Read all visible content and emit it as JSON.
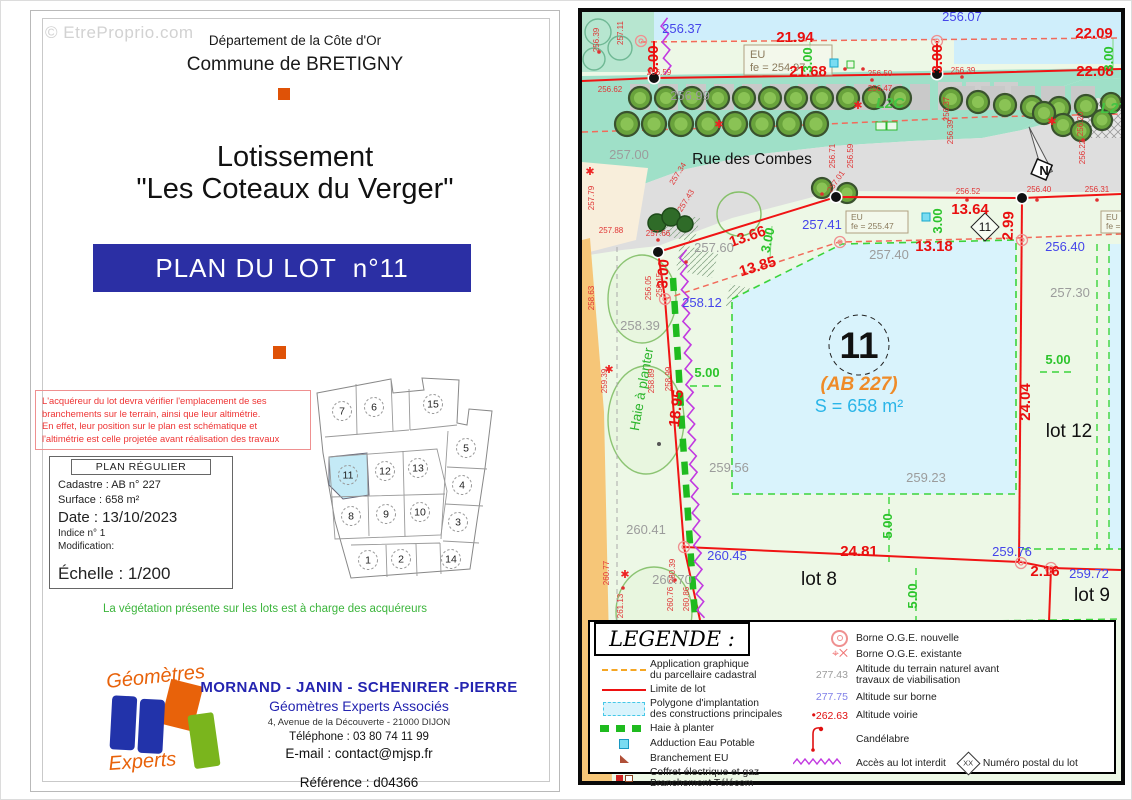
{
  "colors": {
    "banner_blue": "#2b2fa4",
    "footer_blue": "#2424b0",
    "warning_red": "#ee3434",
    "vegetation_green": "#3cb53c",
    "dim_red": "#e90f0f",
    "alt_blue": "#4545ea",
    "alt_gray": "#9c9c9c",
    "dim_green": "#2cc42c",
    "cadastre_orange": "#ef8b28",
    "area_cyan": "#2ab5e8",
    "haie_green": "#1fbb1f",
    "interdit_purple": "#c23ae0",
    "road_gray": "#dedede",
    "verge_teal": "#9fe0c8",
    "lot11_blue": "#d9f3fc",
    "left_strip_orange": "#f6c678",
    "logo_orange": "#e8620a",
    "logo_blue": "#2233aa",
    "logo_green": "#7ab51d"
  },
  "watermark": "© EtreProprio.com",
  "left_page": {
    "header1": "Département de la Côte d'Or",
    "header2": "Commune de BRETIGNY",
    "title1": "Lotissement",
    "title2": "\"Les Coteaux du Verger\"",
    "banner": "PLAN DU LOT  n°11",
    "warning": [
      "L'acquéreur du lot devra vérifier l'emplacement de ses",
      "branchements sur le terrain, ainsi que leur altimétrie.",
      "En effet, leur position sur le plan est schématique et",
      "l'altimétrie est celle projetée avant réalisation des travaux"
    ],
    "plan_box": {
      "title": "PLAN RÉGULIER",
      "cadastre": "Cadastre : AB n° 227",
      "surface": "Surface :  658 m²",
      "date": "Date : 13/10/2023",
      "indice": "Indice n° 1",
      "modification": "Modification:",
      "echelle": "Échelle :  1/200"
    },
    "overview": {
      "highlighted": "11",
      "lots": [
        {
          "n": "7",
          "x": 43,
          "y": 38
        },
        {
          "n": "6",
          "x": 75,
          "y": 34
        },
        {
          "n": "15",
          "x": 134,
          "y": 31
        },
        {
          "n": "5",
          "x": 167,
          "y": 75
        },
        {
          "n": "4",
          "x": 163,
          "y": 112
        },
        {
          "n": "3",
          "x": 159,
          "y": 149
        },
        {
          "n": "14",
          "x": 152,
          "y": 186
        },
        {
          "n": "1",
          "x": 69,
          "y": 187
        },
        {
          "n": "2",
          "x": 102,
          "y": 186
        },
        {
          "n": "8",
          "x": 52,
          "y": 143
        },
        {
          "n": "9",
          "x": 87,
          "y": 141
        },
        {
          "n": "10",
          "x": 121,
          "y": 139
        },
        {
          "n": "11",
          "x": 49,
          "y": 102
        },
        {
          "n": "12",
          "x": 86,
          "y": 98
        },
        {
          "n": "13",
          "x": 119,
          "y": 95
        }
      ]
    },
    "vegetation_note": "La végétation présente sur les lots est à charge des acquéreurs",
    "footer": {
      "firm": "MORNAND - JANIN - SCHENIRER -PIERRE",
      "firm2": "Géomètres Experts Associés",
      "address": "4, Avenue de la Découverte - 21000 DIJON",
      "phone": "Téléphone  : 03 80 74 11 99",
      "email": "E-mail : contact@mjsp.fr",
      "reference": "Référence : d04366"
    },
    "logo": {
      "top": "Géomètres",
      "bottom": "Experts"
    }
  },
  "map": {
    "street": "Rue des Combes",
    "north": "N",
    "lot": {
      "number": "11",
      "cadastre": "(AB 227)",
      "area": "S = 658 m²"
    },
    "diamond": "11",
    "eu_boxes": [
      {
        "l1": "EU",
        "l2": "fe = 254.97"
      },
      {
        "l1": "EU",
        "l2": "fe = 255.47"
      },
      {
        "l1": "EU",
        "l2": "fe = 254"
      }
    ],
    "labels": [
      [
        "21.94",
        213,
        30,
        "r",
        0
      ],
      [
        "22.09",
        512,
        26,
        "r",
        0
      ],
      [
        "21.68",
        226,
        64,
        "r",
        0
      ],
      [
        "22.08",
        513,
        64,
        "r",
        0
      ],
      [
        "3.00",
        76,
        48,
        "r",
        -90
      ],
      [
        "3.00",
        360,
        47,
        "r",
        -90
      ],
      [
        "3.00",
        230,
        48,
        "g",
        -90
      ],
      [
        "3.00",
        531,
        47,
        "g",
        -90
      ],
      [
        "256.37",
        100,
        21,
        "b",
        0
      ],
      [
        "256.07",
        380,
        9,
        "b",
        0
      ],
      [
        "13.66",
        167,
        229,
        "r",
        -19
      ],
      [
        "13.85",
        177,
        259,
        "r",
        -17
      ],
      [
        "3.00",
        190,
        229,
        "g",
        -78
      ],
      [
        "3.00",
        86,
        262,
        "r",
        -87
      ],
      [
        "257.41",
        240,
        217,
        "b",
        0
      ],
      [
        "257.60",
        132,
        240,
        "k",
        0
      ],
      [
        "258.12",
        120,
        295,
        "b",
        0
      ],
      [
        "258.39",
        58,
        318,
        "k",
        0
      ],
      [
        "13.64",
        388,
        202,
        "r",
        0
      ],
      [
        "13.18",
        352,
        239,
        "r",
        0
      ],
      [
        "2.99",
        431,
        214,
        "r",
        -88
      ],
      [
        "3.00",
        360,
        209,
        "g",
        -90
      ],
      [
        "257.40",
        307,
        247,
        "k",
        0
      ],
      [
        "256.40",
        483,
        239,
        "b",
        0
      ],
      [
        "257.30",
        488,
        285,
        "k",
        0
      ],
      [
        "257.00",
        47,
        147,
        "k",
        0
      ],
      [
        "256.99",
        108,
        88,
        "k",
        0
      ],
      [
        "259.56",
        147,
        460,
        "k",
        0
      ],
      [
        "259.23",
        344,
        470,
        "k",
        0
      ],
      [
        "260.41",
        64,
        522,
        "k",
        0
      ],
      [
        "260.45",
        145,
        548,
        "b",
        0
      ],
      [
        "260.70",
        90,
        572,
        "k",
        0
      ],
      [
        "24.04",
        448,
        390,
        "r",
        -90
      ],
      [
        "5.00",
        476,
        352,
        "g",
        0
      ],
      [
        "5.00",
        125,
        365,
        "g",
        0
      ],
      [
        "5.00",
        310,
        514,
        "g",
        -90
      ],
      [
        "5.00",
        335,
        584,
        "g",
        -90
      ],
      [
        "24.81",
        277,
        544,
        "r",
        0
      ],
      [
        "259.76",
        430,
        544,
        "b",
        0
      ],
      [
        "2.16",
        463,
        564,
        "r",
        0
      ],
      [
        "259.72",
        507,
        566,
        "b",
        0
      ],
      [
        "18.95",
        99,
        397,
        "r",
        -83
      ],
      [
        "lot 12",
        487,
        425,
        "L",
        0
      ],
      [
        "lot 8",
        237,
        573,
        "L",
        0
      ],
      [
        "lot 9",
        510,
        589,
        "L",
        0
      ],
      [
        "L2C",
        308,
        96,
        "G",
        0
      ],
      [
        "L2T",
        532,
        101,
        "G",
        0
      ],
      [
        "Haie à planter",
        64,
        378,
        "H",
        -80
      ],
      [
        "256.39",
        17,
        28,
        "s",
        -90
      ],
      [
        "257.11",
        41,
        21,
        "s",
        -90
      ],
      [
        "256.62",
        28,
        80,
        "s",
        0
      ],
      [
        "256.59",
        77,
        63,
        "s",
        0
      ],
      [
        "257.34",
        98,
        163,
        "s",
        -58
      ],
      [
        "257.43",
        106,
        190,
        "s",
        -58
      ],
      [
        "257.79",
        12,
        186,
        "s",
        -90
      ],
      [
        "257.88",
        29,
        221,
        "s",
        0
      ],
      [
        "257.66",
        76,
        224,
        "s",
        0
      ],
      [
        "258.63",
        12,
        286,
        "s",
        -90
      ],
      [
        "256.05",
        69,
        276,
        "s",
        -90
      ],
      [
        "256.15",
        80,
        273,
        "s",
        -90
      ],
      [
        "258.89",
        72,
        369,
        "s",
        -90
      ],
      [
        "258.99",
        89,
        367,
        "s",
        -90
      ],
      [
        "259.39",
        25,
        369,
        "s",
        -90
      ],
      [
        "260.77",
        27,
        561,
        "s",
        -90
      ],
      [
        "260.39",
        93,
        559,
        "s",
        -90
      ],
      [
        "261.13",
        41,
        594,
        "s",
        -90
      ],
      [
        "260.76",
        91,
        587,
        "s",
        -90
      ],
      [
        "260.86",
        107,
        587,
        "s",
        -90
      ],
      [
        "256.50",
        298,
        64,
        "s",
        0
      ],
      [
        "256.47",
        298,
        79,
        "s",
        0
      ],
      [
        "256.37",
        367,
        97,
        "s",
        -90
      ],
      [
        "256.39",
        371,
        120,
        "s",
        -90
      ],
      [
        "256.52",
        386,
        182,
        "s",
        0
      ],
      [
        "256.40",
        457,
        180,
        "s",
        0
      ],
      [
        "256.31",
        515,
        180,
        "s",
        0
      ],
      [
        "256.71",
        253,
        144,
        "s",
        -90
      ],
      [
        "256.59",
        271,
        144,
        "s",
        -90
      ],
      [
        "257.01",
        256,
        171,
        "s",
        -55
      ],
      [
        "256.20",
        501,
        112,
        "s",
        -90
      ],
      [
        "256.22",
        503,
        140,
        "s",
        -90
      ],
      [
        "256.39",
        381,
        61,
        "s",
        0
      ]
    ]
  },
  "legend": {
    "title": "LEGENDE :",
    "left": [
      {
        "l1": "Application graphique",
        "l2": "du parcellaire cadastral"
      },
      {
        "l1": "Limite de lot"
      },
      {
        "l1": "Polygone d'implantation",
        "l2": "des constructions principales"
      },
      {
        "l1": "Haie à planter"
      },
      {
        "l1": "Adduction Eau Potable"
      },
      {
        "l1": "Branchement EU"
      },
      {
        "l1": "Coffret électrique et gaz",
        "l2": "Branchement Télécom"
      }
    ],
    "right": [
      {
        "label": "Borne O.G.E. nouvelle"
      },
      {
        "label": "Borne O.G.E. existante"
      },
      {
        "val": "277.43",
        "l1": "Altitude du terrain naturel avant",
        "l2": "travaux de viabilisation"
      },
      {
        "val": "277.75",
        "label": "Altitude sur borne"
      },
      {
        "val": "262.63",
        "label": "Altitude voirie"
      },
      {
        "label": "Candélabre"
      },
      {
        "label": "Accès au lot interdit"
      }
    ],
    "postal": {
      "sym": "XX",
      "label": "Numéro postal du lot"
    }
  }
}
